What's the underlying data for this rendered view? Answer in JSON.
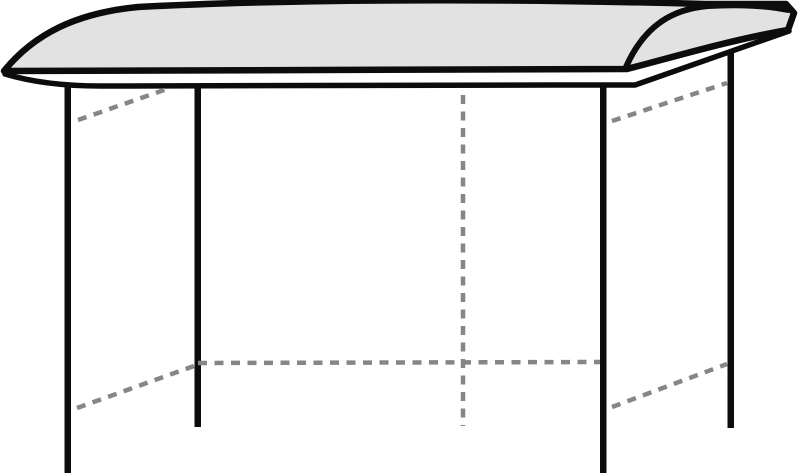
{
  "page": {
    "background": "#ffffff"
  },
  "diagram": {
    "canvas": {
      "width": 800,
      "height": 473
    },
    "colors": {
      "outline": "#0c0c0c",
      "roof_fill": "#e2e2e2",
      "hidden_line": "#868686",
      "background": "#ffffff"
    },
    "shapes": [
      {
        "name": "roof-top-surface",
        "type": "path",
        "d": "M 4 71 C 34 34 76 13 138 7 C 330 -3 560 0 706 4 L 786 4 L 794 13 L 788 30 C 730 40 670 58 627 69 Z",
        "fill": "roof_fill",
        "stroke": "outline",
        "stroke_width": 6.5
      },
      {
        "name": "roof-end-cap-upper-arc",
        "type": "path",
        "d": "M 626 67 C 645 24 674 9 708 6 C 740 4 770 6 788 10",
        "fill": "none",
        "stroke": "outline",
        "stroke_width": 6
      },
      {
        "name": "roof-fascia-lower-edge",
        "type": "path",
        "d": "M 5 74 Q 45 86 100 86 L 555 85 L 635 85 L 789 31",
        "fill": "none",
        "stroke": "outline",
        "stroke_width": 5.5
      },
      {
        "name": "post-front-left",
        "type": "rect",
        "x": 64.5,
        "y": 86,
        "w": 6.5,
        "h": 387,
        "fill": "outline"
      },
      {
        "name": "post-rear-left",
        "type": "rect",
        "x": 194.5,
        "y": 84,
        "w": 6.5,
        "h": 343,
        "fill": "outline"
      },
      {
        "name": "post-front-right",
        "type": "rect",
        "x": 600,
        "y": 84,
        "w": 6.5,
        "h": 389,
        "fill": "outline"
      },
      {
        "name": "post-rear-right",
        "type": "rect",
        "x": 727.5,
        "y": 52,
        "w": 6.5,
        "h": 376,
        "fill": "outline"
      }
    ],
    "hidden_lines": [
      {
        "name": "hidden-rail-top-left",
        "x1": 78,
        "y1": 120,
        "x2": 167,
        "y2": 89
      },
      {
        "name": "hidden-rail-top-right",
        "x1": 612,
        "y1": 121,
        "x2": 727,
        "y2": 83
      },
      {
        "name": "hidden-rail-bottom-left",
        "x1": 77,
        "y1": 408,
        "x2": 194,
        "y2": 366
      },
      {
        "name": "hidden-rail-bottom-right",
        "x1": 612,
        "y1": 407,
        "x2": 727,
        "y2": 364
      },
      {
        "name": "hidden-rail-rear-bottom",
        "x1": 198,
        "y1": 363,
        "x2": 600,
        "y2": 362
      },
      {
        "name": "hidden-center-vertical",
        "x1": 463,
        "y1": 95,
        "x2": 463,
        "y2": 426
      }
    ],
    "hidden_line_style": {
      "stroke_width": 4.5,
      "dash_array": "9 7.5",
      "line_cap": "butt"
    }
  }
}
